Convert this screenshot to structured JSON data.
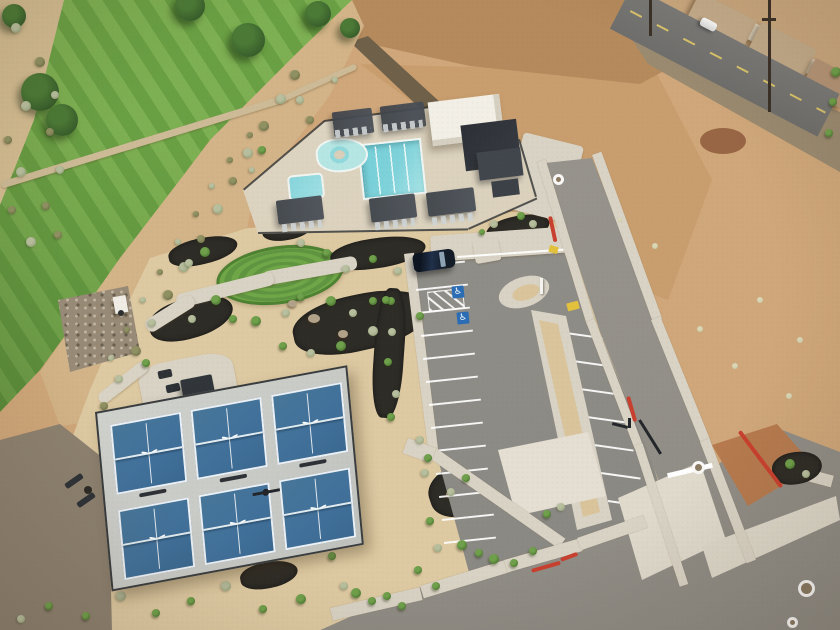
{
  "scene": {
    "type": "aerial-drone-photo",
    "subject": "Community recreation center with swimming pool, clubhouse, six pickleball courts, striped parking lot and desert landscaping beside a golf course fairway",
    "setting": "red-rock desert community"
  },
  "palette": {
    "sand": "#decaa2",
    "desert_red": "#b97a4e",
    "desert_tan": "#cfa77a",
    "scrub_base": "#d6c096",
    "golf_light": "#7db052",
    "golf_dark": "#6aa044",
    "tree_green": "#39602c",
    "rock_gray": "#8d8170",
    "mulch_black": "#2e2c27",
    "bush_green": "#4e7a32",
    "bush_sage": "#97a37c",
    "bush_pale": "#c2c49e",
    "bush_olive": "#6e7048",
    "concrete": "#d9d3c5",
    "concrete_bright": "#e4dfd2",
    "asphalt": "#8e8c86",
    "road_asphalt": "#95928b",
    "curb_red": "#c8402f",
    "pool_deck": "#d9cfba",
    "water": "#7fd2da",
    "water_light": "#b5e6e4",
    "structure_dark": "#373c42",
    "roof_white": "#f2efe6",
    "court_blue": "#41719b",
    "court_gray": "#c8cac6",
    "line_white": "#ffffff",
    "suv_black": "#131c27",
    "ramp_yellow": "#e2c23c",
    "hc_blue": "#2a6db5",
    "house_roof": "#c4ac8b",
    "lawn_green": "#65a83f"
  },
  "counts": {
    "pickleball_courts": 6,
    "court_bird_logos": 6,
    "pool_pergolas_top": 2,
    "pool_pergolas_bottom": 3,
    "parking_stall_lines_left": 13,
    "parking_stall_lines_right": 7,
    "accessible_stall_symbols": 2,
    "vehicles_visible": 2,
    "manhole_markings": 4
  },
  "markings": {
    "accessible_symbol": "♿"
  },
  "spawn": {
    "trees": [
      {
        "x": 40,
        "y": 92,
        "r": 19
      },
      {
        "x": 62,
        "y": 120,
        "r": 16
      },
      {
        "x": 190,
        "y": 6,
        "r": 15
      },
      {
        "x": 248,
        "y": 40,
        "r": 17
      },
      {
        "x": 318,
        "y": 14,
        "r": 13
      },
      {
        "x": 14,
        "y": 16,
        "r": 12
      },
      {
        "x": 350,
        "y": 28,
        "r": 10
      }
    ],
    "bushes": [
      {
        "x": 295,
        "y": 75,
        "r": 5,
        "t": "o"
      },
      {
        "x": 281,
        "y": 99,
        "r": 5,
        "t": "s"
      },
      {
        "x": 264,
        "y": 126,
        "r": 5,
        "t": "o"
      },
      {
        "x": 248,
        "y": 153,
        "r": 5,
        "t": "s"
      },
      {
        "x": 233,
        "y": 181,
        "r": 4,
        "t": "o"
      },
      {
        "x": 218,
        "y": 209,
        "r": 5,
        "t": "s"
      },
      {
        "x": 201,
        "y": 239,
        "r": 4,
        "t": "o"
      },
      {
        "x": 184,
        "y": 267,
        "r": 5,
        "t": "s"
      },
      {
        "x": 168,
        "y": 295,
        "r": 5,
        "t": "o"
      },
      {
        "x": 152,
        "y": 323,
        "r": 4,
        "t": "s"
      },
      {
        "x": 136,
        "y": 351,
        "r": 5,
        "t": "o"
      },
      {
        "x": 119,
        "y": 379,
        "r": 4,
        "t": "s"
      },
      {
        "x": 104,
        "y": 406,
        "r": 4,
        "t": "o"
      },
      {
        "x": 250,
        "y": 135,
        "r": 3,
        "t": "o"
      },
      {
        "x": 230,
        "y": 160,
        "r": 3,
        "t": "o"
      },
      {
        "x": 212,
        "y": 186,
        "r": 3,
        "t": "s"
      },
      {
        "x": 196,
        "y": 214,
        "r": 3,
        "t": "o"
      },
      {
        "x": 178,
        "y": 242,
        "r": 3,
        "t": "s"
      },
      {
        "x": 160,
        "y": 272,
        "r": 3,
        "t": "o"
      },
      {
        "x": 143,
        "y": 300,
        "r": 3,
        "t": "s"
      },
      {
        "x": 127,
        "y": 330,
        "r": 3,
        "t": "o"
      },
      {
        "x": 111,
        "y": 358,
        "r": 3,
        "t": "s"
      },
      {
        "x": 16,
        "y": 28,
        "r": 5,
        "t": "s"
      },
      {
        "x": 40,
        "y": 62,
        "r": 5,
        "t": "o"
      },
      {
        "x": 26,
        "y": 106,
        "r": 5,
        "t": "s"
      },
      {
        "x": 50,
        "y": 132,
        "r": 4,
        "t": "o"
      },
      {
        "x": 21,
        "y": 172,
        "r": 5,
        "t": "s"
      },
      {
        "x": 46,
        "y": 206,
        "r": 4,
        "t": "o"
      },
      {
        "x": 31,
        "y": 242,
        "r": 5,
        "t": "s"
      },
      {
        "x": 12,
        "y": 210,
        "r": 4,
        "t": "o"
      },
      {
        "x": 8,
        "y": 140,
        "r": 4,
        "t": "o"
      },
      {
        "x": 55,
        "y": 95,
        "r": 4,
        "t": "s"
      },
      {
        "x": 60,
        "y": 170,
        "r": 4,
        "t": "s"
      },
      {
        "x": 58,
        "y": 235,
        "r": 4,
        "t": "o"
      },
      {
        "x": 205,
        "y": 252,
        "r": 5,
        "t": "g"
      },
      {
        "x": 189,
        "y": 263,
        "r": 4,
        "t": "s"
      },
      {
        "x": 216,
        "y": 300,
        "r": 5,
        "t": "g"
      },
      {
        "x": 233,
        "y": 319,
        "r": 4,
        "t": "g"
      },
      {
        "x": 192,
        "y": 319,
        "r": 4,
        "t": "s"
      },
      {
        "x": 256,
        "y": 321,
        "r": 5,
        "t": "g"
      },
      {
        "x": 286,
        "y": 313,
        "r": 4,
        "t": "s"
      },
      {
        "x": 301,
        "y": 297,
        "r": 4,
        "t": "g"
      },
      {
        "x": 331,
        "y": 301,
        "r": 5,
        "t": "g"
      },
      {
        "x": 353,
        "y": 313,
        "r": 4,
        "t": "s"
      },
      {
        "x": 373,
        "y": 301,
        "r": 4,
        "t": "g"
      },
      {
        "x": 346,
        "y": 269,
        "r": 4,
        "t": "s"
      },
      {
        "x": 327,
        "y": 253,
        "r": 4,
        "t": "g"
      },
      {
        "x": 301,
        "y": 243,
        "r": 4,
        "t": "s"
      },
      {
        "x": 373,
        "y": 259,
        "r": 4,
        "t": "g"
      },
      {
        "x": 398,
        "y": 271,
        "r": 4,
        "t": "s"
      },
      {
        "x": 391,
        "y": 301,
        "r": 4,
        "t": "g"
      },
      {
        "x": 420,
        "y": 316,
        "r": 4,
        "t": "g"
      },
      {
        "x": 373,
        "y": 331,
        "r": 5,
        "t": "s"
      },
      {
        "x": 341,
        "y": 346,
        "r": 5,
        "t": "g"
      },
      {
        "x": 311,
        "y": 353,
        "r": 4,
        "t": "s"
      },
      {
        "x": 283,
        "y": 346,
        "r": 4,
        "t": "g"
      },
      {
        "x": 262,
        "y": 150,
        "r": 4,
        "t": "g"
      },
      {
        "x": 252,
        "y": 170,
        "r": 3,
        "t": "s"
      },
      {
        "x": 386,
        "y": 300,
        "r": 4,
        "t": "g"
      },
      {
        "x": 392,
        "y": 332,
        "r": 4,
        "t": "s"
      },
      {
        "x": 388,
        "y": 362,
        "r": 4,
        "t": "g"
      },
      {
        "x": 396,
        "y": 394,
        "r": 4,
        "t": "s"
      },
      {
        "x": 391,
        "y": 417,
        "r": 4,
        "t": "g"
      },
      {
        "x": 506,
        "y": 206,
        "r": 5,
        "t": "g"
      },
      {
        "x": 521,
        "y": 216,
        "r": 4,
        "t": "g"
      },
      {
        "x": 533,
        "y": 224,
        "r": 4,
        "t": "s"
      },
      {
        "x": 494,
        "y": 224,
        "r": 4,
        "t": "s"
      },
      {
        "x": 482,
        "y": 232,
        "r": 3,
        "t": "g"
      },
      {
        "x": 266,
        "y": 212,
        "r": 4,
        "t": "g"
      },
      {
        "x": 280,
        "y": 220,
        "r": 4,
        "t": "s"
      },
      {
        "x": 296,
        "y": 226,
        "r": 4,
        "t": "g"
      },
      {
        "x": 356,
        "y": 593,
        "r": 5,
        "t": "g"
      },
      {
        "x": 372,
        "y": 601,
        "r": 4,
        "t": "g"
      },
      {
        "x": 387,
        "y": 596,
        "r": 4,
        "t": "g"
      },
      {
        "x": 402,
        "y": 606,
        "r": 4,
        "t": "g"
      },
      {
        "x": 344,
        "y": 586,
        "r": 4,
        "t": "s"
      },
      {
        "x": 301,
        "y": 599,
        "r": 5,
        "t": "g"
      },
      {
        "x": 263,
        "y": 609,
        "r": 4,
        "t": "g"
      },
      {
        "x": 226,
        "y": 586,
        "r": 5,
        "t": "s"
      },
      {
        "x": 191,
        "y": 601,
        "r": 4,
        "t": "g"
      },
      {
        "x": 156,
        "y": 613,
        "r": 4,
        "t": "g"
      },
      {
        "x": 121,
        "y": 596,
        "r": 5,
        "t": "s"
      },
      {
        "x": 86,
        "y": 616,
        "r": 4,
        "t": "g"
      },
      {
        "x": 49,
        "y": 606,
        "r": 4,
        "t": "g"
      },
      {
        "x": 21,
        "y": 619,
        "r": 4,
        "t": "s"
      },
      {
        "x": 436,
        "y": 586,
        "r": 4,
        "t": "g"
      },
      {
        "x": 462,
        "y": 545,
        "r": 5,
        "t": "g"
      },
      {
        "x": 479,
        "y": 553,
        "r": 4,
        "t": "g"
      },
      {
        "x": 494,
        "y": 559,
        "r": 5,
        "t": "g"
      },
      {
        "x": 514,
        "y": 563,
        "r": 4,
        "t": "g"
      },
      {
        "x": 533,
        "y": 551,
        "r": 4,
        "t": "g"
      },
      {
        "x": 547,
        "y": 514,
        "r": 4,
        "t": "g"
      },
      {
        "x": 561,
        "y": 507,
        "r": 4,
        "t": "s"
      },
      {
        "x": 430,
        "y": 521,
        "r": 4,
        "t": "g"
      },
      {
        "x": 451,
        "y": 492,
        "r": 4,
        "t": "s"
      },
      {
        "x": 466,
        "y": 478,
        "r": 4,
        "t": "g"
      },
      {
        "x": 425,
        "y": 473,
        "r": 4,
        "t": "s"
      },
      {
        "x": 438,
        "y": 548,
        "r": 4,
        "t": "s"
      },
      {
        "x": 418,
        "y": 570,
        "r": 4,
        "t": "g"
      },
      {
        "x": 332,
        "y": 556,
        "r": 4,
        "t": "g"
      },
      {
        "x": 318,
        "y": 544,
        "r": 4,
        "t": "s"
      },
      {
        "x": 836,
        "y": 72,
        "r": 5,
        "t": "g"
      },
      {
        "x": 833,
        "y": 102,
        "r": 4,
        "t": "g"
      },
      {
        "x": 829,
        "y": 133,
        "r": 4,
        "t": "g"
      },
      {
        "x": 700,
        "y": 329,
        "r": 3,
        "t": "p"
      },
      {
        "x": 735,
        "y": 366,
        "r": 3,
        "t": "p"
      },
      {
        "x": 789,
        "y": 396,
        "r": 3,
        "t": "p"
      },
      {
        "x": 655,
        "y": 246,
        "r": 3,
        "t": "p"
      },
      {
        "x": 620,
        "y": 220,
        "r": 2,
        "t": "p"
      },
      {
        "x": 760,
        "y": 300,
        "r": 3,
        "t": "p"
      },
      {
        "x": 800,
        "y": 340,
        "r": 3,
        "t": "p"
      },
      {
        "x": 790,
        "y": 464,
        "r": 5,
        "t": "g"
      },
      {
        "x": 806,
        "y": 474,
        "r": 4,
        "t": "s"
      },
      {
        "x": 420,
        "y": 440,
        "r": 4,
        "t": "s"
      },
      {
        "x": 428,
        "y": 458,
        "r": 4,
        "t": "g"
      },
      {
        "x": 300,
        "y": 100,
        "r": 4,
        "t": "s"
      },
      {
        "x": 310,
        "y": 120,
        "r": 4,
        "t": "o"
      },
      {
        "x": 335,
        "y": 80,
        "r": 3,
        "t": "s"
      },
      {
        "x": 146,
        "y": 363,
        "r": 4,
        "t": "g"
      }
    ],
    "left_stalls": {
      "count": 13,
      "x": 413,
      "y": 266,
      "dx": 2.6,
      "dy": 23,
      "len": 52,
      "rot": -6
    },
    "right_stalls": {
      "count": 7,
      "x": 566,
      "y": 332,
      "dx": 7,
      "dy": 28,
      "len": 40,
      "rot": 8
    },
    "courts": {
      "cols": 3,
      "rows": 2,
      "x0": 12,
      "y0": 14,
      "w": 73,
      "h": 72,
      "gx": 10,
      "gy": 16
    },
    "manholes": [
      {
        "x": 558,
        "y": 179,
        "d": 11
      },
      {
        "x": 698,
        "y": 467,
        "d": 13
      },
      {
        "x": 806,
        "y": 588,
        "d": 17
      },
      {
        "x": 792,
        "y": 622,
        "d": 11
      }
    ],
    "red_curbs": [
      {
        "x": 552,
        "y": 216,
        "len": 26,
        "rot": 78
      },
      {
        "x": 630,
        "y": 396,
        "len": 26,
        "rot": 74
      },
      {
        "x": 741,
        "y": 430,
        "len": 70,
        "rot": 53
      },
      {
        "x": 531,
        "y": 569,
        "len": 30,
        "rot": -16
      },
      {
        "x": 560,
        "y": 558,
        "len": 18,
        "rot": -20
      }
    ]
  }
}
